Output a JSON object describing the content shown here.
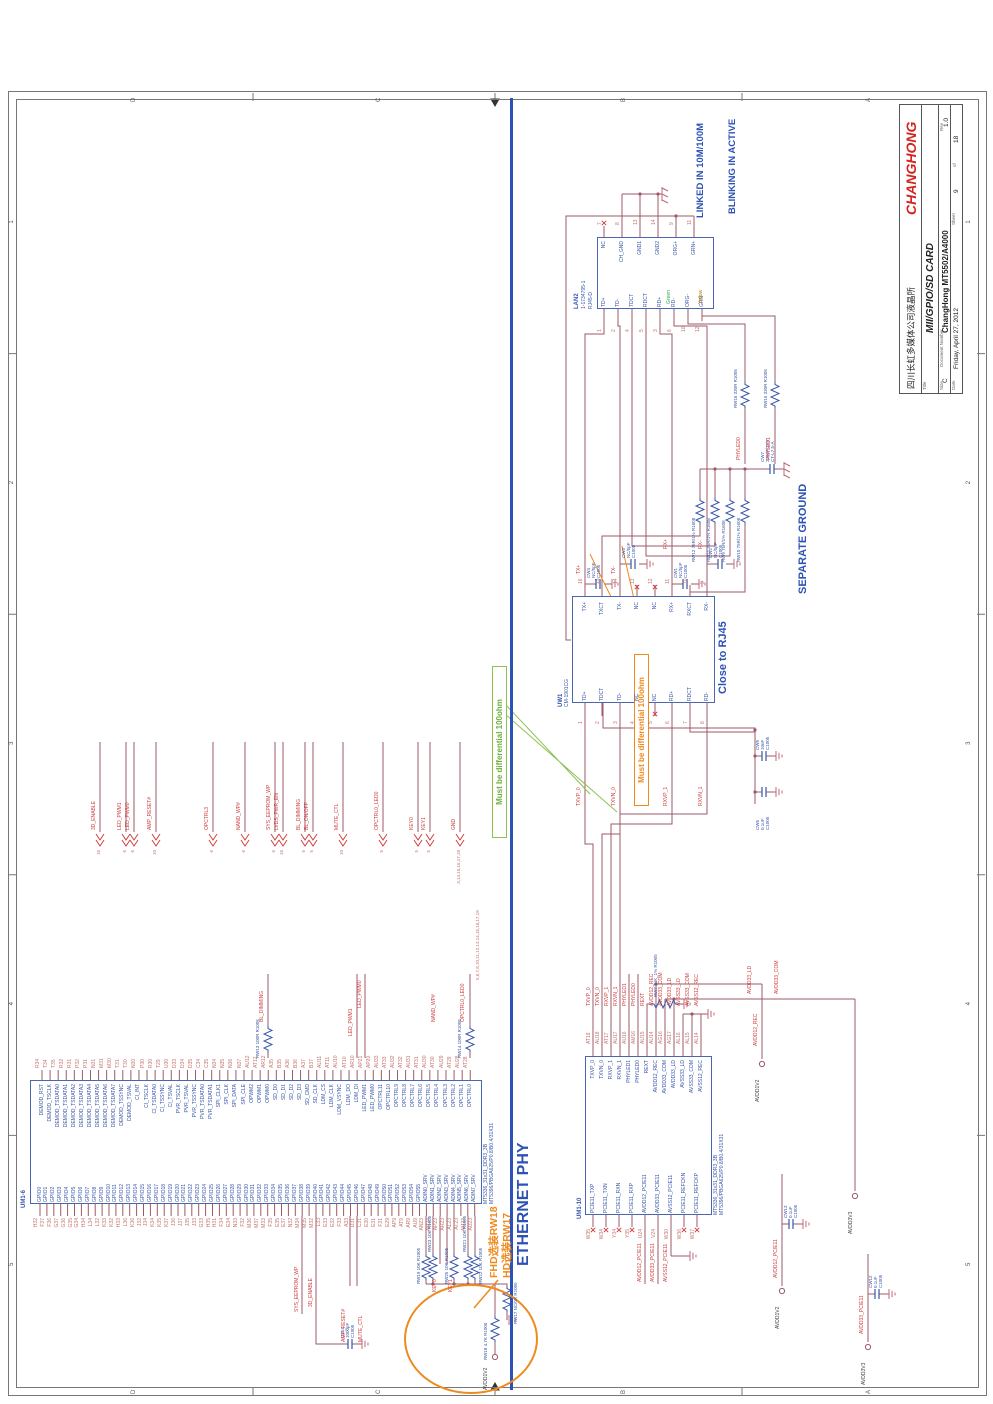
{
  "colors": {
    "wire": "#9e5967",
    "net": "#cf4040",
    "comp": "#3a57a8",
    "pin": "#c4726f",
    "note_orange": "#ef8a1d",
    "note_green": "#6fae3c",
    "section_blue": "#2d52b5",
    "brand_red": "#d42420"
  },
  "page": {
    "zones": {
      "letters": [
        "D",
        "C",
        "B",
        "A"
      ],
      "numbers": [
        "5",
        "4",
        "3",
        "2",
        "1"
      ]
    }
  },
  "title_block": {
    "company_cn": "四川长虹多媒体公司液晶所",
    "brand": "CHANGHONG",
    "title_label": "Title",
    "title": "MII/GPIO/SD CARD",
    "size_label": "Size",
    "size": "C",
    "doc_label": "Document Number",
    "doc_number": "ChangHong MT5502/A4000",
    "rev_label": "Rev",
    "rev": "1.0",
    "date_label": "Date",
    "date": "Friday, April 27, 2012",
    "sheet_label": "Sheet",
    "sheet": "9",
    "of_label": "of",
    "total": "18"
  },
  "section": {
    "label": "ETHERNET PHY"
  },
  "notes": {
    "diff_green": "Must be differential 100ohm",
    "diff_orange": "Must be differential 100ohm",
    "close_rj45": "Close to RJ45",
    "separate_ground": "SEPARATE GROUND",
    "linked": "LINKED IN 10M/100M",
    "blinking": "BLINKING IN ACTIVE",
    "fit_line1": "FHD选装RW18",
    "fit_line2": "HD选装RW17",
    "bus_sheet_refs": "5,6,7,8,10,11,12,13,14,15,16,17,19"
  },
  "um1_6": {
    "ref": "UM1-6",
    "part1": "MT5336_31x31_DDR3_3B",
    "part2": "MT5396/PBGA625/P0.8/B0.4/31X31",
    "left_pins": [
      {
        "n": "H32",
        "s": "GPIO0"
      },
      {
        "n": "F37",
        "s": "GPIO1"
      },
      {
        "n": "F36",
        "s": "GPIO2"
      },
      {
        "n": "G37",
        "s": "GPIO3"
      },
      {
        "n": "G36",
        "s": "GPIO4"
      },
      {
        "n": "G35",
        "s": "GPIO5"
      },
      {
        "n": "G34",
        "s": "GPIO6"
      },
      {
        "n": "H34",
        "s": "GPIO7"
      },
      {
        "n": "L34",
        "s": "GPIO8"
      },
      {
        "n": "L32",
        "s": "GPIO9"
      },
      {
        "n": "K33",
        "s": "GPIO10"
      },
      {
        "n": "K32",
        "s": "GPIO11"
      },
      {
        "n": "H33",
        "s": "GPIO12"
      },
      {
        "n": "L36",
        "s": "GPIO13"
      },
      {
        "n": "K36",
        "s": "GPIO14"
      },
      {
        "n": "J32",
        "s": "GPIO15"
      },
      {
        "n": "J34",
        "s": "GPIO16"
      },
      {
        "n": "K34",
        "s": "GPIO17"
      },
      {
        "n": "K35",
        "s": "GPIO18"
      },
      {
        "n": "K37",
        "s": "GPIO19"
      },
      {
        "n": "J36",
        "s": "GPIO20"
      },
      {
        "n": "J37",
        "s": "GPIO21"
      },
      {
        "n": "J35",
        "s": "GPIO22"
      },
      {
        "n": "J33",
        "s": "GPIO23"
      },
      {
        "n": "G33",
        "s": "GPIO24"
      },
      {
        "n": "H35",
        "s": "GPIO25"
      },
      {
        "n": "H31",
        "s": "GPIO26"
      },
      {
        "n": "F34",
        "s": "GPIO27"
      },
      {
        "n": "E34",
        "s": "GPIO28"
      },
      {
        "n": "N33",
        "s": "GPIO29"
      },
      {
        "n": "F32",
        "s": "GPIO30"
      },
      {
        "n": "M36",
        "s": "GPIO31"
      },
      {
        "n": "M37",
        "s": "GPIO32"
      },
      {
        "n": "M33",
        "s": "GPIO33"
      },
      {
        "n": "F35",
        "s": "GPIO34"
      },
      {
        "n": "E35",
        "s": "GPIO35"
      },
      {
        "n": "E37",
        "s": "GPIO36"
      },
      {
        "n": "N32",
        "s": "GPIO37"
      },
      {
        "n": "M34",
        "s": "GPIO38"
      },
      {
        "n": "M35",
        "s": "GPIO39"
      },
      {
        "n": "M32",
        "s": "GPIO40"
      },
      {
        "n": "L33",
        "s": "GPIO41"
      },
      {
        "n": "E33",
        "s": "GPIO42"
      },
      {
        "n": "E32",
        "s": "GPIO43"
      },
      {
        "n": "F33",
        "s": "GPIO44"
      },
      {
        "n": "A33",
        "s": "GPIO45"
      },
      {
        "n": "D31",
        "s": "GPIO46"
      },
      {
        "n": "C31",
        "s": "GPIO47"
      },
      {
        "n": "E30",
        "s": "GPIO48"
      },
      {
        "n": "E31",
        "s": "GPIO49"
      },
      {
        "n": "F31",
        "s": "GPIO50"
      },
      {
        "n": "E29",
        "s": "GPIO51"
      },
      {
        "n": "AP9",
        "s": "GPIO52"
      },
      {
        "n": "AT9",
        "s": "GPIO53"
      },
      {
        "n": "AR9",
        "s": "GPIO54"
      },
      {
        "n": "AU9",
        "s": "GPIO55"
      },
      {
        "n": "AN23",
        "s": "ADIN0_SRV"
      },
      {
        "n": "AM24",
        "s": "ADIN1_SRV"
      },
      {
        "n": "AP23",
        "s": "ADIN2_SRV"
      },
      {
        "n": "AR23",
        "s": "ADIN3_SRV"
      },
      {
        "n": "AL23",
        "s": "ADIN4_SRV"
      },
      {
        "n": "AT23",
        "s": "ADIN5_SRV"
      },
      {
        "n": "AM23",
        "s": "ADIN6_SRV"
      },
      {
        "n": "AU23",
        "s": "ADIN7_SRV"
      }
    ],
    "right_pins": [
      {
        "n": "R34",
        "s": "DEMOD_RST"
      },
      {
        "n": "T34",
        "s": "DEMOD_TSCLK"
      },
      {
        "n": "T35",
        "s": "DEMOD_TSDATA0"
      },
      {
        "n": "R32",
        "s": "DEMOD_TSDATA1"
      },
      {
        "n": "R31",
        "s": "DEMOD_TSDATA2"
      },
      {
        "n": "P32",
        "s": "DEMOD_TSDATA3"
      },
      {
        "n": "P31",
        "s": "DEMOD_TSDATA4"
      },
      {
        "n": "N31",
        "s": "DEMOD_TSDATA5"
      },
      {
        "n": "M31",
        "s": "DEMOD_TSDATA6"
      },
      {
        "n": "M30",
        "s": "DEMOD_TSDATA7"
      },
      {
        "n": "T31",
        "s": "DEMOD_TSSYNC"
      },
      {
        "n": "T30",
        "s": "DEMOD_TSVAL"
      },
      {
        "n": "N30",
        "s": "CI_INT"
      },
      {
        "n": "P30",
        "s": "CI_TSCLK"
      },
      {
        "n": "R30",
        "s": "CI_TSDATA0"
      },
      {
        "n": "T29",
        "s": "CI_TSSYNC"
      },
      {
        "n": "U30",
        "s": "CI_TSVAL"
      },
      {
        "n": "D33",
        "s": "PVR_TSCLK"
      },
      {
        "n": "D34",
        "s": "PVR_TSVAL"
      },
      {
        "n": "D35",
        "s": "PVR_TSSYNC"
      },
      {
        "n": "C34",
        "s": "PVR_TSDATA0"
      },
      {
        "n": "C35",
        "s": "PVR_TSDATA1"
      },
      {
        "n": "N34",
        "s": "SPI_CLK1"
      },
      {
        "n": "N35",
        "s": "SPI_CLK"
      },
      {
        "n": "N36",
        "s": "SPI_DATA"
      },
      {
        "n": "N37",
        "s": "SPI_CLE"
      },
      {
        "n": "AU12",
        "s": "OPWM2"
      },
      {
        "n": "AT12",
        "s": "OPWM1"
      },
      {
        "n": "AR12",
        "s": "OPWM0"
      },
      {
        "n": "A35",
        "s": "SD_D0"
      },
      {
        "n": "B35",
        "s": "SD_D1"
      },
      {
        "n": "A36",
        "s": "SD_D2"
      },
      {
        "n": "B36",
        "s": "SD_D3"
      },
      {
        "n": "A37",
        "s": "SD_CMD"
      },
      {
        "n": "B37",
        "s": "SD_CLK"
      },
      {
        "n": "AU11",
        "s": "LDM_CS"
      },
      {
        "n": "AT11",
        "s": "LDM_CLK"
      },
      {
        "n": "AU10",
        "s": "LDM_VSYNC"
      },
      {
        "n": "AT10",
        "s": "LDM_DO"
      },
      {
        "n": "AR10",
        "s": "LDM_DI"
      },
      {
        "n": "AP21",
        "s": "LED_PWM1"
      },
      {
        "n": "AP20",
        "s": "LED_PWM0"
      },
      {
        "n": "AU33",
        "s": "OPCTRL11"
      },
      {
        "n": "AT33",
        "s": "OPCTRL10"
      },
      {
        "n": "AU32",
        "s": "OPCTRL9"
      },
      {
        "n": "AT32",
        "s": "OPCTRL8"
      },
      {
        "n": "AU31",
        "s": "OPCTRL7"
      },
      {
        "n": "AT31",
        "s": "OPCTRL6"
      },
      {
        "n": "AU30",
        "s": "OPCTRL5"
      },
      {
        "n": "AT30",
        "s": "OPCTRL4"
      },
      {
        "n": "AU29",
        "s": "OPCTRL3"
      },
      {
        "n": "AT29",
        "s": "OPCTRL2"
      },
      {
        "n": "AU28",
        "s": "OPCTRL1"
      },
      {
        "n": "AT28",
        "s": "OPCTRL0"
      }
    ]
  },
  "um1_10": {
    "ref": "UM1-10",
    "part1": "MT5336_31x31_DDR3_3B",
    "part2": "MT5396/PBGA625/P0.8/B0.4/31X31",
    "left_pins": [
      {
        "n": "W35",
        "s": "PCIE11_TXP"
      },
      {
        "n": "W34",
        "s": "PCIE11_TXN"
      },
      {
        "n": "Y34",
        "s": "PCIE11_RXN"
      },
      {
        "n": "Y35",
        "s": "PCIE11_RXP"
      },
      {
        "n": "U24",
        "s": "AVDD12_PCIE11"
      },
      {
        "n": "V24",
        "s": "AVDD33_PCIE11"
      },
      {
        "n": "W30",
        "s": "AVSS12_PCIE11"
      },
      {
        "n": "W36",
        "s": "PCIE11_REFCKN"
      },
      {
        "n": "W37",
        "s": "PCIE11_REFCKP"
      }
    ],
    "right_pins": [
      {
        "n": "AT18",
        "s": "TXVP_0"
      },
      {
        "n": "AU18",
        "s": "TXVN_0"
      },
      {
        "n": "AT17",
        "s": "RXVP_1"
      },
      {
        "n": "AU17",
        "s": "RXVN_1"
      },
      {
        "n": "AU16",
        "s": "PHYLED1"
      },
      {
        "n": "AM16",
        "s": "PHYLED0"
      },
      {
        "n": "AU15",
        "s": "REXT"
      },
      {
        "n": "AU14",
        "s": "AVDD12_REC"
      },
      {
        "n": "AG16",
        "s": "AVDD33_COM"
      },
      {
        "n": "AG17",
        "s": "AVDD33_LD"
      },
      {
        "n": "AL16",
        "s": "AVSS33_LD"
      },
      {
        "n": "AL15",
        "s": "AVSS33_COM"
      },
      {
        "n": "AL14",
        "s": "AVSS12_REC"
      }
    ]
  },
  "uw1": {
    "ref": "UW1",
    "part": "CM-1901CG",
    "left_pins": [
      {
        "n": "1",
        "s": "TD+"
      },
      {
        "n": "2",
        "s": "TDCT"
      },
      {
        "n": "3",
        "s": "TD-"
      },
      {
        "n": "4",
        "s": "NC"
      },
      {
        "n": "5",
        "s": "NC"
      },
      {
        "n": "6",
        "s": "RD+"
      },
      {
        "n": "7",
        "s": "RDCT"
      },
      {
        "n": "8",
        "s": "RD-"
      }
    ],
    "right_pins": [
      {
        "n": "16",
        "s": "TX+"
      },
      {
        "n": "15",
        "s": "TXCT"
      },
      {
        "n": "14",
        "s": "TX-"
      },
      {
        "n": "13",
        "s": "NC"
      },
      {
        "n": "12",
        "s": "NC"
      },
      {
        "n": "11",
        "s": "RX+"
      },
      {
        "n": "10",
        "s": "RXCT"
      },
      {
        "n": "9",
        "s": "RX-"
      }
    ]
  },
  "lan2": {
    "ref": "LAN2",
    "part1": "1-1734795-1",
    "part2": "RJ45-D",
    "left_pins": [
      {
        "n": "1",
        "s": "TD+"
      },
      {
        "n": "2",
        "s": "TD-"
      },
      {
        "n": "4",
        "s": "TDCT"
      },
      {
        "n": "5",
        "s": "RDCT"
      },
      {
        "n": "3",
        "s": "RD+"
      },
      {
        "n": "6",
        "s": "RD-"
      },
      {
        "n": "10",
        "s": "ORG-"
      },
      {
        "n": "12",
        "s": "GRN-"
      }
    ],
    "right_pins": [
      {
        "n": "7",
        "s": "NC"
      },
      {
        "n": "8",
        "s": "CH_GND"
      },
      {
        "n": "13",
        "s": "GND1"
      },
      {
        "n": "14",
        "s": "GND2"
      },
      {
        "n": "9",
        "s": "ORG+"
      },
      {
        "n": "11",
        "s": "GRN+"
      }
    ],
    "led_green": "Green",
    "led_yellow": "Yellow"
  },
  "offpage": [
    {
      "sheets": "16",
      "net": "3D_ENABLE"
    },
    {
      "sheets": "6",
      "net": "LED_PWM1"
    },
    {
      "sheets": "6",
      "net": "LED_PWM0"
    },
    {
      "sheets": "10",
      "net": "AMP_RESET#"
    },
    {
      "sheets": "6",
      "net": "OPCTRL3"
    },
    {
      "sheets": "6",
      "net": "NAND_WP#"
    },
    {
      "sheets": "6",
      "net": "SYS_EEPROM_WP"
    },
    {
      "sheets": "16",
      "net": "LVDS_PWR_EN"
    },
    {
      "sheets": "5",
      "net": "BL_DIMMING"
    },
    {
      "sheets": "5",
      "net": "BL_ON/OFF"
    },
    {
      "sheets": "10",
      "net": "MUTE_CTL"
    },
    {
      "sheets": "5",
      "net": "OPCTRL0_LED0"
    },
    {
      "sheets": "5",
      "net": "KEY0"
    },
    {
      "sheets": "5",
      "net": "KEY1"
    },
    {
      "sheets": "3,14,15,16,17,18",
      "net": "GND"
    }
  ],
  "nets": {
    "txvp0": "TXVP_0",
    "txvn0": "TXVN_0",
    "rxvp1": "RXVP_1",
    "rxvn1": "RXVN_1",
    "txp": "TX+",
    "txm": "TX-",
    "rxp": "RX+",
    "rxm": "RX-",
    "phyled0": "PHYLED0",
    "phyled1": "PHYLED1",
    "avdd12_rec": "AVDD12_REC",
    "avdd12_pcie": "AVDD12_PCIE11",
    "avdd33_pcie": "AVDD33_PCIE11",
    "avdd33_ld": "AVDD33_LD",
    "avdd33_com": "AVDD33_COM",
    "en3d": "3D_ENABLE",
    "sys_eeprom": "SYS_EEPROM_WP",
    "amp_reset": "AMP_RESET#",
    "mute": "MUTE_CTL",
    "key0": "KEY0",
    "key1": "KEY1",
    "nand_wp": "NAND_WP#",
    "bl_dimming": "BL_DIMMING",
    "opctrl0_led0": "OPCTRL0_LED0",
    "led_pwm1": "LED_PWM1",
    "led_pwm0": "LED_PWM0"
  },
  "power_rails": {
    "v12": "AVDD1V2",
    "v33": "AVDD3V3"
  },
  "resistors": [
    {
      "ref": "RW13",
      "val": "100R",
      "pkg": "R1005"
    },
    {
      "ref": "RW14",
      "val": "100R",
      "pkg": "R1005"
    },
    {
      "ref": "RW19",
      "val": "10K",
      "pkg": "R1005"
    },
    {
      "ref": "RW23",
      "val": "10K",
      "pkg": "R1005"
    },
    {
      "ref": "RW25",
      "val": "10K",
      "pkg": "R1005"
    },
    {
      "ref": "RW21",
      "val": "10K",
      "pkg": "R1005"
    },
    {
      "ref": "RW22",
      "val": "10K",
      "pkg": "R1005"
    },
    {
      "ref": "RW17",
      "val": "NC/0R",
      "pkg": "R1005"
    },
    {
      "ref": "RW18",
      "val": "4.7K",
      "pkg": "R1005"
    },
    {
      "ref": "RW7",
      "val": "24K_1%",
      "pkg": "R1005"
    },
    {
      "ref": "RW9",
      "val": "75R/1%",
      "pkg": "R1608"
    },
    {
      "ref": "RW10",
      "val": "75R/1%",
      "pkg": "R1608"
    },
    {
      "ref": "RW11",
      "val": "75R/1%",
      "pkg": "R1608"
    },
    {
      "ref": "RW12",
      "val": "75R/1%",
      "pkg": "R1608"
    },
    {
      "ref": "RW15",
      "val": "330R",
      "pkg": "R1005"
    },
    {
      "ref": "RW16",
      "val": "330R",
      "pkg": "R1005"
    }
  ],
  "caps": [
    {
      "ref": "C314",
      "val": "1000pF",
      "pkg": "C1005"
    },
    {
      "ref": "CW13",
      "val": "0.1uF",
      "pkg": "C1005"
    },
    {
      "ref": "CW12",
      "val": "0.1uF",
      "pkg": "C1005"
    },
    {
      "ref": "CW6",
      "val": "0.1uF",
      "pkg": "C1005"
    },
    {
      "ref": "CW9",
      "val": "10nF",
      "pkg": "C1005"
    },
    {
      "ref": "CW7",
      "val": "220pF/2KV",
      "pkg": "CT-L7.5-A"
    },
    {
      "ref": "CW1",
      "val": "NC/5pF",
      "pkg": "C1005"
    },
    {
      "ref": "CW2",
      "val": "NC/5pF",
      "pkg": "C1005"
    },
    {
      "ref": "CW3",
      "val": "NC/5pF",
      "pkg": "C1005"
    },
    {
      "ref": "CW4",
      "val": "NC/5pF",
      "pkg": "C1005"
    }
  ]
}
